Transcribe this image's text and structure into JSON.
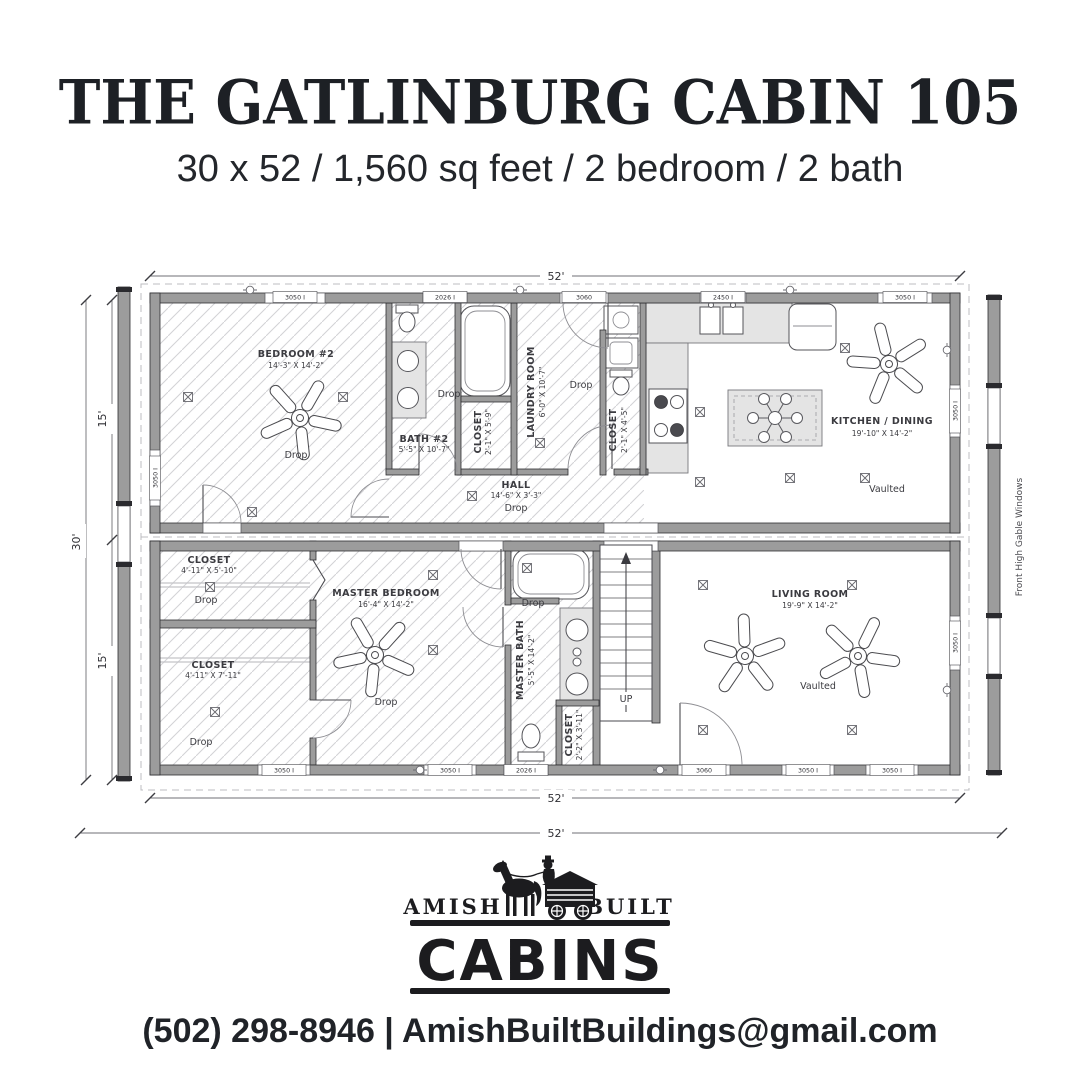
{
  "header": {
    "title": "THE GATLINBURG CABIN 105",
    "subtitle": "30 x 52 / 1,560 sq feet / 2 bedroom / 2 bath"
  },
  "colors": {
    "ink": "#1d2025",
    "wall_gray": "#9c9c9c"
  },
  "floorplan": {
    "dimensions": {
      "width": "52'",
      "height": "30'",
      "half": "15'"
    },
    "side_note": "Front High Gable Windows",
    "stairs": {
      "up": "UP"
    },
    "windows": {
      "w3050": "3050 I",
      "w2026": "2026 I",
      "w2450": "2450 I",
      "d3060": "3060"
    },
    "rooms": {
      "bedroom2": {
        "name": "BEDROOM #2",
        "size": "14'-3\" X 14'-2\"",
        "ceiling": "Drop"
      },
      "bath2": {
        "name": "BATH #2",
        "size": "5'-5\" X 10'-7\"",
        "ceiling": "Drop"
      },
      "closet_bath2": {
        "name": "CLOSET",
        "size": "2'-1\" X 5'-9\""
      },
      "laundry": {
        "name": "LAUNDRY ROOM",
        "size": "6'-0\" X 10'-7\"",
        "ceiling": "Drop"
      },
      "closet_kitchen": {
        "name": "CLOSET",
        "size": "2'-1\" X 4'-5\""
      },
      "hall": {
        "name": "HALL",
        "size": "14'-6\" X 3'-3\"",
        "ceiling": "Drop"
      },
      "kitchen": {
        "name": "KITCHEN / DINING",
        "size": "19'-10\" X 14'-2\"",
        "ceiling": "Vaulted"
      },
      "master_bedroom": {
        "name": "MASTER BEDROOM",
        "size": "16'-4\" X 14'-2\"",
        "ceiling": "Drop"
      },
      "closet_master1": {
        "name": "CLOSET",
        "size": "4'-11\" X 5'-10\"",
        "ceiling": "Drop"
      },
      "closet_master2": {
        "name": "CLOSET",
        "size": "4'-11\" X 7'-11\"",
        "ceiling": "Drop"
      },
      "master_bath": {
        "name": "MASTER BATH",
        "size": "5'-5\" X 14'-2\"",
        "ceiling": "Drop"
      },
      "closet_stairs": {
        "name": "CLOSET",
        "size": "2'-2\" X 3'-11\""
      },
      "living": {
        "name": "LIVING ROOM",
        "size": "19'-9\" X 14'-2\"",
        "ceiling": "Vaulted"
      }
    }
  },
  "logo": {
    "left": "AMISH",
    "right": "BUILT",
    "main": "CABINS"
  },
  "footer": {
    "contact": "(502) 298-8946 | AmishBuiltBuildings@gmail.com"
  }
}
